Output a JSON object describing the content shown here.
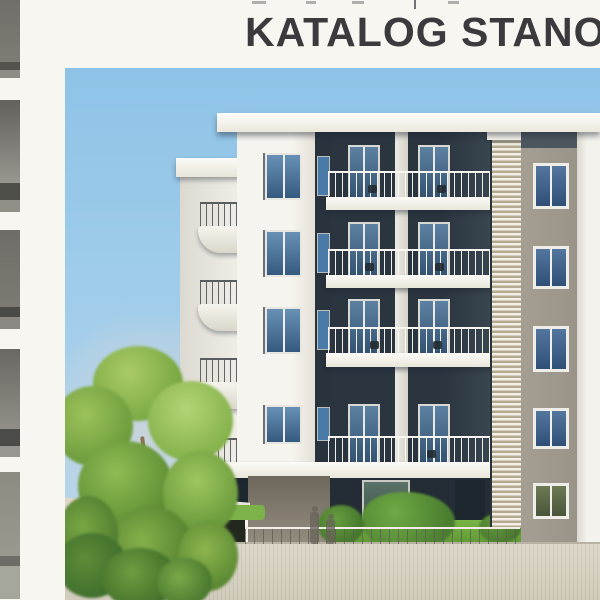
{
  "header": {
    "title": "KATALOG STANOV"
  },
  "palette": {
    "page_background": "#f8f6f1",
    "title_color": "#3b3b3d",
    "sky": "#9bc9e9",
    "facade_white": "#f4f2ec",
    "facade_dark": "#2c3742",
    "side_wall_beige": "#a09a8e",
    "window_glass_blue": "#47749f",
    "louver_tan": "#b3a98e",
    "grass_green": "#69a93c",
    "tree_green": "#8ab54e",
    "concrete_wall": "#d8d2c4"
  },
  "scene": {
    "description": "3D architectural rendering of a modern multi-storey apartment building with white balcony slabs, dark recessed facade, vertical louver screen, beige side wall with windows, large green tree, shrubs, lawn strip, concrete retaining wall and translucent human silhouettes under a clear blue sky.",
    "left_edge": "narrow cropped sliver of the neighbouring catalog page"
  }
}
